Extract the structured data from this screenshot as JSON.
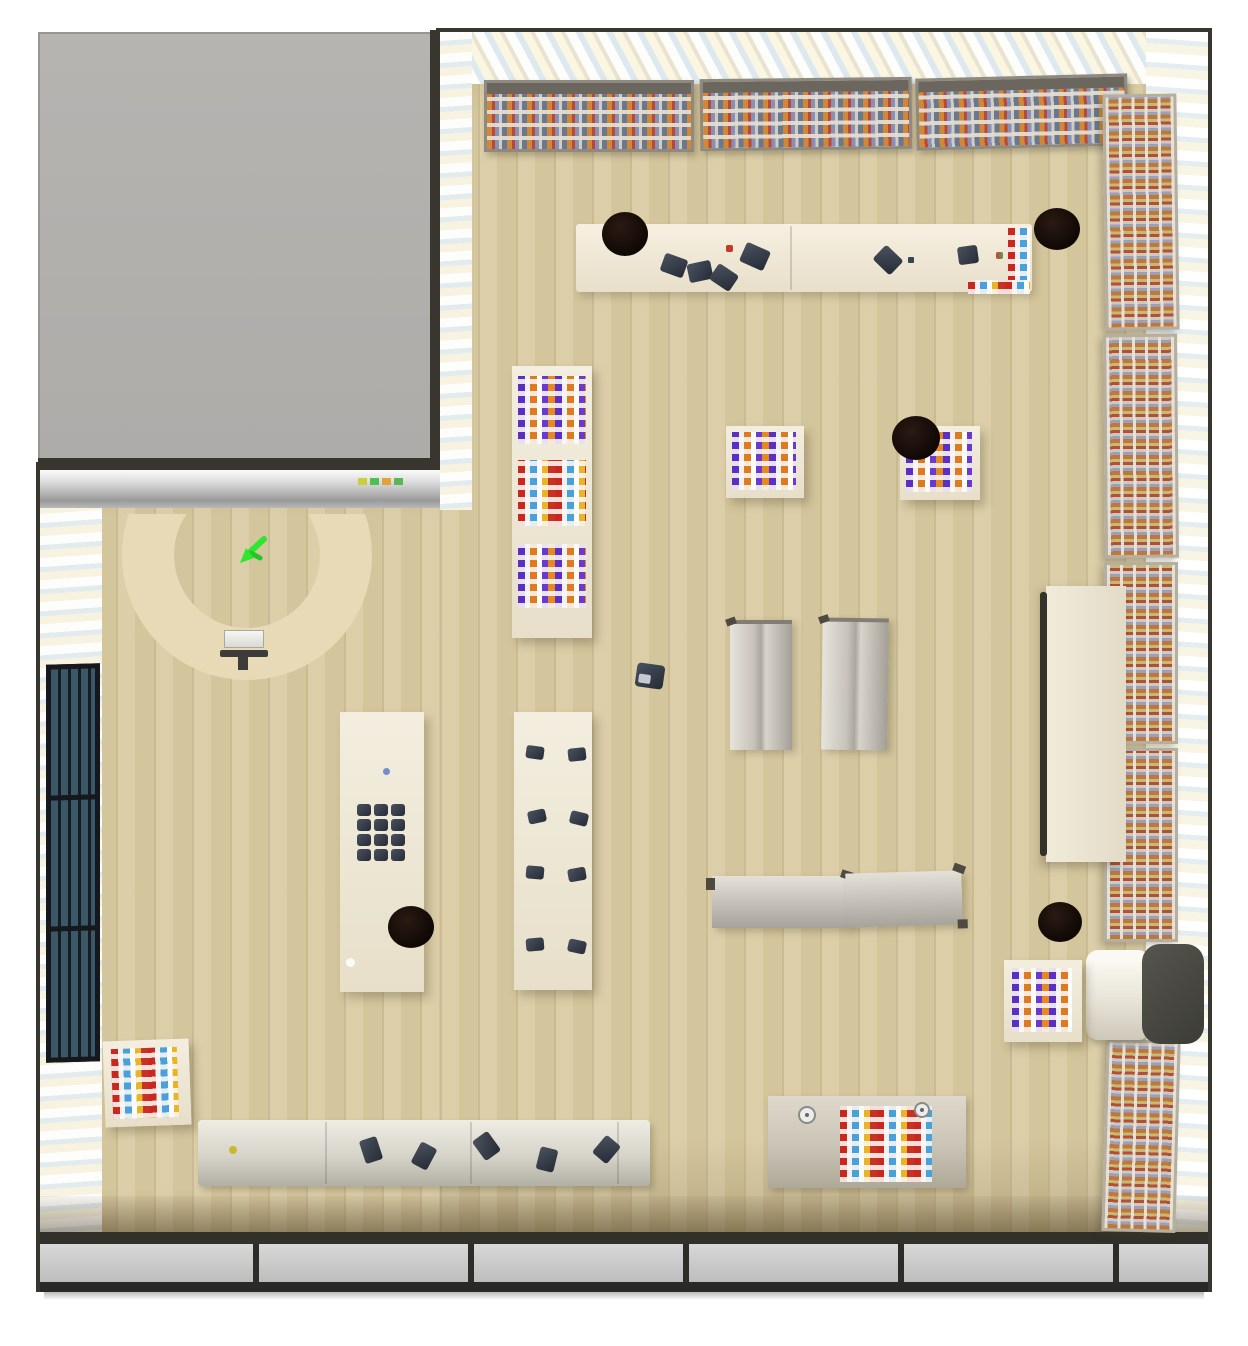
{
  "scene": {
    "title": "Top-down rendered view of a simulated retail store",
    "view": "top-down orthographic-like 3D render",
    "room_shape": "L-shaped",
    "floor_material": "light wood planks",
    "wall_material": "pastel striped wallpaper (white / light blue / pale yellow)",
    "unexplored_block": {
      "label": "gray unexplored / neighboring area",
      "position": "top-left",
      "color": "#b3b1ae"
    },
    "agent_marker": {
      "label": "agent position marker",
      "shape": "green arrow",
      "color": "#2ee62e",
      "location": "inside U-shaped counter"
    },
    "colors": {
      "floor": "#d9cba2",
      "floor_plank_line": "#9b875a",
      "wall_stripe_blue": "#dde9ee",
      "wall_stripe_yellow": "#f8f3e0",
      "counter_cream": "#e9dab7",
      "display_white": "#f0ead9",
      "bin_black": "#140c08",
      "shoe_dark": "#323a46",
      "mosaic_purple": "#5b2fc4",
      "mosaic_orange": "#e07a1e",
      "mosaic_red": "#c8281e",
      "mosaic_blue": "#4aa0d8",
      "mosaic_yellow": "#e8b428",
      "room_border": "#38362f",
      "gray_block": "#b3b1ae",
      "window_glass": "#3c5866"
    },
    "objects": [
      {
        "name": "ceiling-merchandise-shelf",
        "count": 3,
        "location": "along top wall",
        "contents": "rows of small multicolor products"
      },
      {
        "name": "long-display-counter",
        "count": 1,
        "location": "upper area",
        "items_on_top": "6 dark shoes, 1 red item, multicolor product strip at right end"
      },
      {
        "name": "round-black-bin",
        "count": 5,
        "locations": "left end of top counter, right of top counter, mid-right mosaic table, left shoe display, lower right floor"
      },
      {
        "name": "mosaic-product-table-purple-orange",
        "count": 5
      },
      {
        "name": "mosaic-product-table-red-blue",
        "count": 3
      },
      {
        "name": "vertical-shoe-display-strip",
        "count": 2,
        "contents": "grid of dark shoes"
      },
      {
        "name": "empty-gondola-shelf",
        "count": 4,
        "detail": "2 vertical, 2 horizontal, gray"
      },
      {
        "name": "tall-cream-cabinet-panel",
        "count": 1,
        "location": "against right wall"
      },
      {
        "name": "wall-merchandise-rack",
        "count": 5,
        "location": "right wall",
        "contents": "striped multicolor products"
      },
      {
        "name": "rolled-mat-with-dark-end",
        "count": 1,
        "location": "lower right, against right wall"
      },
      {
        "name": "u-shaped-reception-counter",
        "count": 1,
        "location": "lower-left section",
        "accessories": "cash register, dark stand"
      },
      {
        "name": "low-shoe-bench",
        "count": 1,
        "location": "bottom left",
        "items_on_top": "5 dark shoes, 1 yellow dot item"
      },
      {
        "name": "product-table-with-round-items",
        "count": 1,
        "location": "bottom right",
        "items_on_top": "red-blue mosaic products, 2 white round objects"
      },
      {
        "name": "dark-grid-window",
        "count": 1,
        "location": "left wall",
        "detail": "3 sections of vertical slats"
      },
      {
        "name": "storefront-glass-wall",
        "count": 1,
        "location": "bottom wall",
        "detail": "gray glass panels with 5 dark mullions"
      },
      {
        "name": "single-shoe-on-floor",
        "count": 1,
        "location": "center of main floor"
      },
      {
        "name": "indicator-dots-sign",
        "count": 1,
        "location": "on silver wall band below gray block",
        "colors": [
          "#c9cf3e",
          "#4fc04f",
          "#e2a23a",
          "#58b858"
        ]
      }
    ]
  }
}
